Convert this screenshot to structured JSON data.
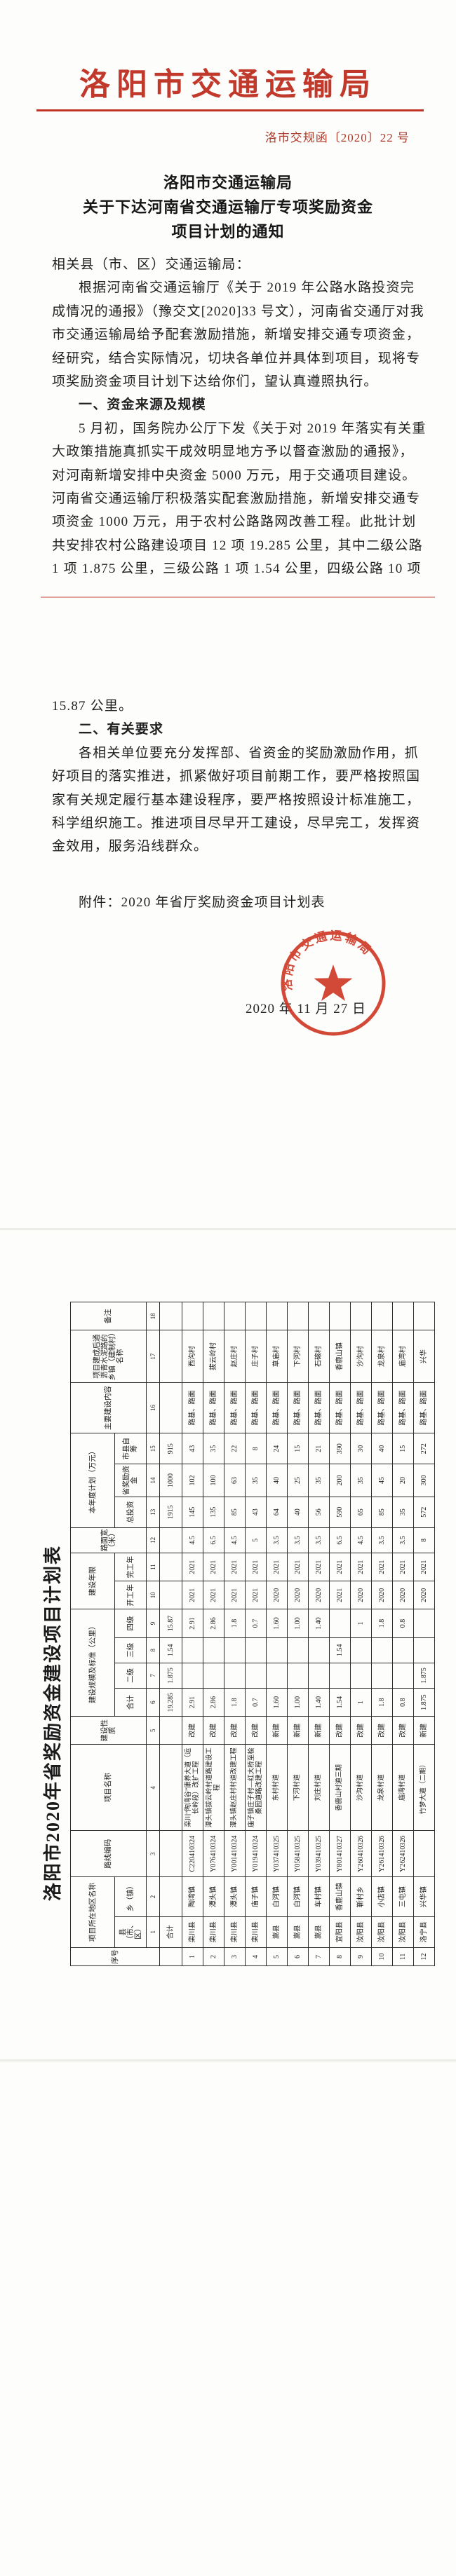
{
  "letterhead": {
    "agency": "洛阳市交通运输局",
    "doc_number": "洛市交规函〔2020〕22 号"
  },
  "doc_title_lines": [
    "洛阳市交通运输局",
    "关于下达河南省交通运输厅专项奖励资金",
    "项目计划的通知"
  ],
  "body": {
    "page1_lines": [
      {
        "t": "相关县（市、区）交通运输局：",
        "i": false,
        "b": false
      },
      {
        "t": "根据河南省交通运输厅《关于 2019 年公路水路投资完",
        "i": true,
        "b": false
      },
      {
        "t": "成情况的通报》（豫交文[2020]33 号文），河南省交通厅对我",
        "i": false,
        "b": false
      },
      {
        "t": "市交通运输局给予配套激励措施，新增安排交通专项资金，",
        "i": false,
        "b": false
      },
      {
        "t": "经研究，结合实际情况，切块各单位并具体到项目，现将专",
        "i": false,
        "b": false
      },
      {
        "t": "项奖励资金项目计划下达给你们，望认真遵照执行。",
        "i": false,
        "b": false
      },
      {
        "t": "一、资金来源及规模",
        "i": true,
        "b": true
      },
      {
        "t": "5 月初，国务院办公厅下发《关于对 2019 年落实有关重",
        "i": true,
        "b": false
      },
      {
        "t": "大政策措施真抓实干成效明显地方予以督查激励的通报》，",
        "i": false,
        "b": false
      },
      {
        "t": "对河南新增安排中央资金 5000 万元，用于交通项目建设。",
        "i": false,
        "b": false
      },
      {
        "t": "河南省交通运输厅积极落实配套激励措施，新增安排交通专",
        "i": false,
        "b": false
      },
      {
        "t": "项资金 1000 万元，用于农村公路路网改善工程。此批计划",
        "i": false,
        "b": false
      },
      {
        "t": "共安排农村公路建设项目 12 项 19.285 公里，其中二级公路",
        "i": false,
        "b": false
      },
      {
        "t": "1 项 1.875 公里，三级公路 1 项 1.54 公里，四级公路 10 项",
        "i": false,
        "b": false
      }
    ],
    "page2_lines": [
      {
        "t": "15.87 公里。",
        "i": false,
        "b": false
      },
      {
        "t": "二、有关要求",
        "i": true,
        "b": true
      },
      {
        "t": "各相关单位要充分发挥部、省资金的奖励激励作用，抓",
        "i": true,
        "b": false
      },
      {
        "t": "好项目的落实推进，抓紧做好项目前期工作，要严格按照国",
        "i": false,
        "b": false
      },
      {
        "t": "家有关规定履行基本建设程序，要严格按照设计标准施工，",
        "i": false,
        "b": false
      },
      {
        "t": "科学组织施工。推进项目尽早开工建设，尽早完工，发挥资",
        "i": false,
        "b": false
      },
      {
        "t": "金效用，服务沿线群众。",
        "i": false,
        "b": false
      }
    ],
    "attachment_line": "附件：2020 年省厅奖励资金项目计划表"
  },
  "seal": {
    "arc_text": "洛阳市交通运输局",
    "date": "2020 年 11 月 27 日",
    "color": "#cf3a28"
  },
  "table": {
    "title": "洛阳市2020年省奖励资金建设项目计划表",
    "header_groups": [
      {
        "label": "序号",
        "w": 26,
        "span_all": true
      },
      {
        "label": "项目所在地区名称",
        "cols": [
          {
            "label": "县（市、区）",
            "num": "1",
            "w": 44
          },
          {
            "label": "乡（镇）",
            "num": "2",
            "w": 56
          }
        ]
      },
      {
        "label": "路线编码",
        "num": "3",
        "w": 66
      },
      {
        "label": "项目名称",
        "num": "4",
        "w": 122
      },
      {
        "label": "建设性质",
        "num": "5",
        "w": 40
      },
      {
        "label": "建设规模及标准（公里）",
        "cols": [
          {
            "label": "合计",
            "num": "6",
            "w": 40
          },
          {
            "label": "二级",
            "num": "7",
            "w": 36
          },
          {
            "label": "三级",
            "num": "8",
            "w": 36
          },
          {
            "label": "四级",
            "num": "9",
            "w": 40
          }
        ]
      },
      {
        "label": "建设年限",
        "cols": [
          {
            "label": "开工年",
            "num": "10",
            "w": 40
          },
          {
            "label": "完工年",
            "num": "11",
            "w": 40
          }
        ]
      },
      {
        "label": "路面宽（米）",
        "num": "12",
        "w": 36
      },
      {
        "label": "本年度计划（万元）",
        "cols": [
          {
            "label": "总投资",
            "num": "13",
            "w": 44
          },
          {
            "label": "省奖励资金",
            "num": "14",
            "w": 46
          },
          {
            "label": "市县自筹",
            "num": "15",
            "w": 44
          }
        ]
      },
      {
        "label": "主要建设内容",
        "num": "16",
        "w": 72
      },
      {
        "label": "项目建成后通沥青水泥路的乡镇（建制村）名称",
        "num": "17",
        "w": 74
      },
      {
        "label": "备注",
        "num": "18",
        "w": 40
      }
    ],
    "total_row": [
      "",
      "合计",
      "",
      "",
      "",
      "",
      "19.285",
      "1.875",
      "1.54",
      "15.87",
      "",
      "",
      "",
      "1915",
      "1000",
      "915",
      "",
      "",
      ""
    ],
    "rows": [
      [
        "1",
        "栾川县",
        "陶湾镇",
        "C220410324",
        "栾川“陶湾谷”康养大道（运长岭段）改扩工程",
        "改建",
        "2.91",
        "",
        "",
        "2.91",
        "2021",
        "2021",
        "4.5",
        "145",
        "102",
        "43",
        "路基、路面",
        "西沟村",
        ""
      ],
      [
        "2",
        "栾川县",
        "潭头镇",
        "Y076410324",
        "潭头镇拔云岭村道路建设工程",
        "改建",
        "2.86",
        "",
        "",
        "2.86",
        "2021",
        "2021",
        "6.5",
        "135",
        "100",
        "35",
        "路基、路面",
        "拔云岭村",
        ""
      ],
      [
        "3",
        "栾川县",
        "潭头镇",
        "Y001410324",
        "潭头镇赵庄村村道改建工程",
        "改建",
        "1.8",
        "",
        "",
        "1.8",
        "2021",
        "2021",
        "4.5",
        "85",
        "63",
        "22",
        "路基、路面",
        "赵庄村",
        ""
      ],
      [
        "4",
        "栾川县",
        "庙子镇",
        "Y019410324",
        "庙子镇庄子村—红大桥至桧桑园道路改建工程",
        "改建",
        "0.7",
        "",
        "",
        "0.7",
        "2021",
        "2021",
        "5",
        "43",
        "35",
        "8",
        "路基、路面",
        "庄子村",
        ""
      ],
      [
        "5",
        "嵩县",
        "白河镇",
        "Y037410325",
        "东村村道",
        "新建",
        "1.60",
        "",
        "",
        "1.60",
        "2020",
        "2021",
        "3.5",
        "64",
        "40",
        "24",
        "路基、路面",
        "草庙村",
        ""
      ],
      [
        "6",
        "嵩县",
        "白河镇",
        "Y058410325",
        "下河村道",
        "新建",
        "1.00",
        "",
        "",
        "1.00",
        "2020",
        "2021",
        "3.5",
        "40",
        "25",
        "15",
        "路基、路面",
        "下河村",
        ""
      ],
      [
        "7",
        "嵩县",
        "车村镇",
        "Y039410325",
        "刘庄村道",
        "新建",
        "1.40",
        "",
        "",
        "1.40",
        "2020",
        "2021",
        "3.5",
        "56",
        "35",
        "21",
        "路基、路面",
        "石磙村",
        ""
      ],
      [
        "8",
        "宜阳县",
        "香鹿山镇",
        "Y801410327",
        "香鹿山村道三期",
        "改建",
        "1.54",
        "",
        "1.54",
        "",
        "2021",
        "2021",
        "6.5",
        "590",
        "200",
        "390",
        "路基、路面",
        "香鹿山镇",
        ""
      ],
      [
        "9",
        "汝阳县",
        "靳村乡",
        "Y260410326",
        "沙沟村道",
        "改建",
        "1",
        "",
        "",
        "1",
        "2020",
        "2021",
        "4.5",
        "65",
        "35",
        "30",
        "路基、路面",
        "沙沟村",
        ""
      ],
      [
        "10",
        "汝阳县",
        "小店镇",
        "Y261410326",
        "龙泉村道",
        "改建",
        "1.8",
        "",
        "",
        "1.8",
        "2020",
        "2021",
        "3.5",
        "85",
        "45",
        "40",
        "路基、路面",
        "龙泉村",
        ""
      ],
      [
        "11",
        "汝阳县",
        "三屯镇",
        "Y262410326",
        "庙湾村道",
        "改建",
        "0.8",
        "",
        "",
        "0.8",
        "2020",
        "2021",
        "3.5",
        "35",
        "20",
        "15",
        "路基、路面",
        "庙湾村",
        ""
      ],
      [
        "12",
        "洛宁县",
        "兴华镇",
        "",
        "竹梦大道（二期）",
        "新建",
        "1.875",
        "1.875",
        "",
        "",
        "2020",
        "2021",
        "8",
        "572",
        "300",
        "272",
        "路基、路面",
        "兴华",
        ""
      ]
    ]
  }
}
